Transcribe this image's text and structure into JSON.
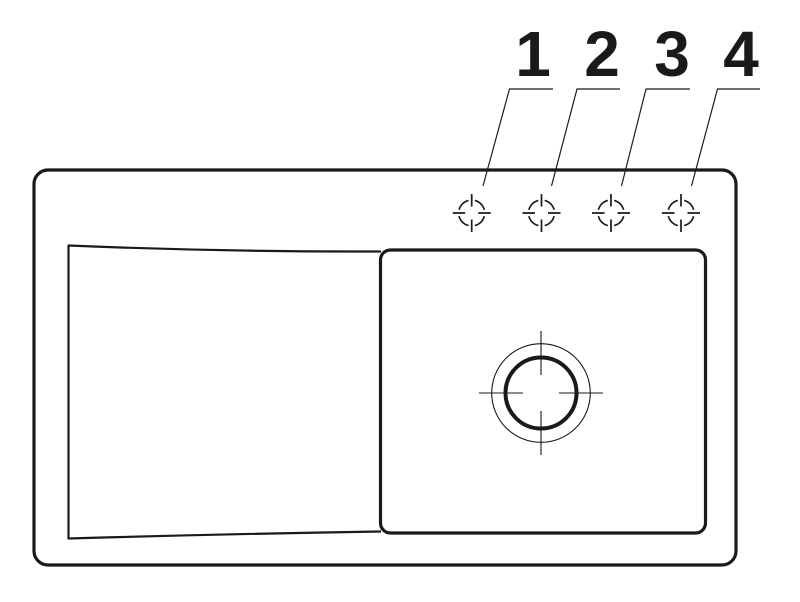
{
  "drawing": {
    "description": "sink-top-view-technical-drawing",
    "background_color": "#ffffff",
    "line_color": "#1a1a1a",
    "tap_hole_labels": {
      "hole_1": "1",
      "hole_2": "2",
      "hole_3": "3",
      "hole_4": "4"
    }
  }
}
